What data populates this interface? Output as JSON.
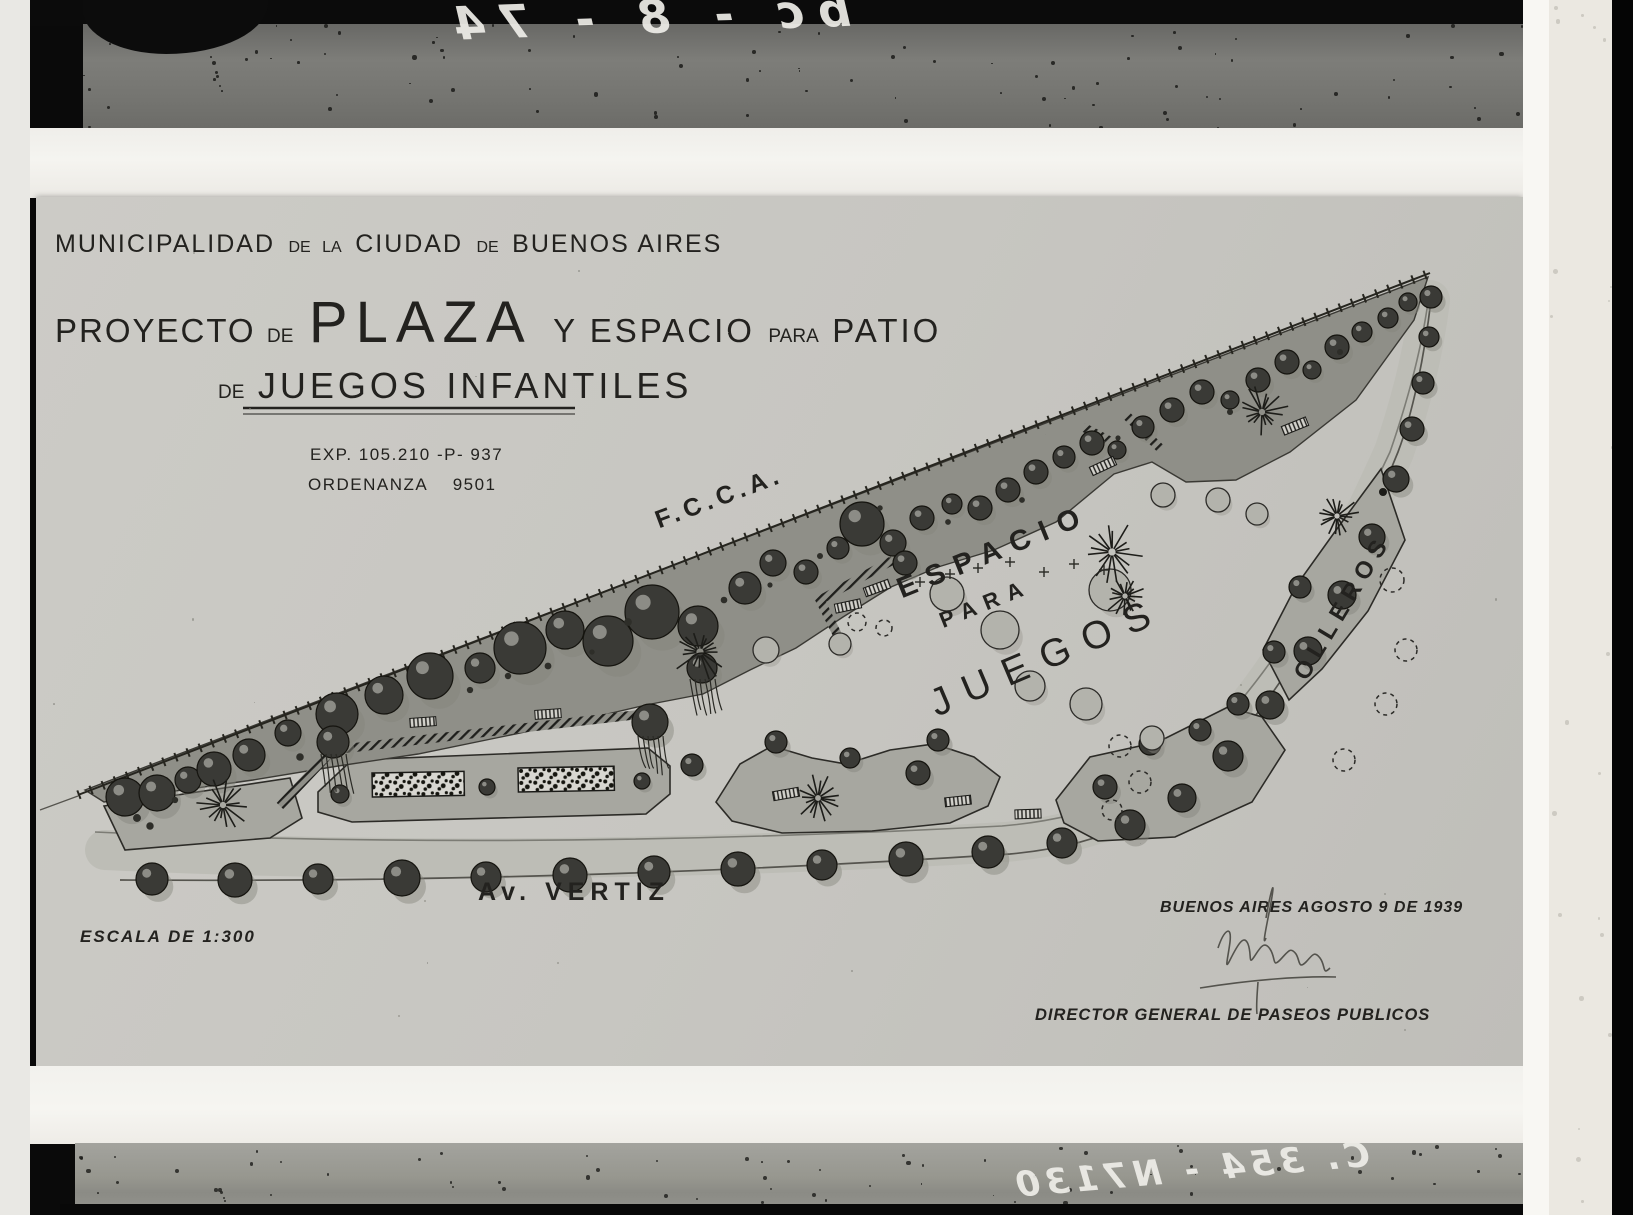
{
  "photo_plate": {
    "top_inscription": "bc - 8 - 74",
    "bottom_inscription": "C. 354 - N7130"
  },
  "title_block": {
    "municipality": {
      "w1": "MUNICIPALIDAD",
      "w2": "DE",
      "w3": "LA",
      "w4": "CIUDAD",
      "w5": "DE",
      "w6": "BUENOS AIRES"
    },
    "project": {
      "w1": "PROYECTO",
      "w2": "DE",
      "w3": "PLAZA",
      "w4": "Y ESPACIO",
      "w5": "PARA",
      "w6": "PATIO"
    },
    "subtitle": {
      "w1": "DE",
      "w2": "JUEGOS",
      "w3": "INFANTILES"
    },
    "file_number": "EXP. 105.210 -P- 937",
    "ordinance_label": "ORDENANZA",
    "ordinance_value": "9501"
  },
  "plan_labels": {
    "railway": "F.C.C.A.",
    "espacio": "ESPACIO",
    "para": "PARA",
    "juegos": "JUEGOS",
    "street_right": "OLLEROS",
    "avenue": "Av. VERTIZ",
    "scale": "ESCALA DE 1:300"
  },
  "footer": {
    "date_line": "BUENOS AIRES AGOSTO 9 DE 1939",
    "signature_title": "DIRECTOR GENERAL DE PASEOS PUBLICOS"
  },
  "colors": {
    "paper": "#c8c7c2",
    "ink": "#23221f",
    "woodland": "#8f8f88",
    "parcel": "#a7a7a0",
    "sidewalk": "#bdbdb6",
    "tree_dark": "#3a3a36",
    "tree_light": "#b3b3ac",
    "frame_black": "#0a0a0a",
    "wood_top": "#757572",
    "wood_bottom": "#9b9b96",
    "border_white": "#f1f0ec"
  }
}
